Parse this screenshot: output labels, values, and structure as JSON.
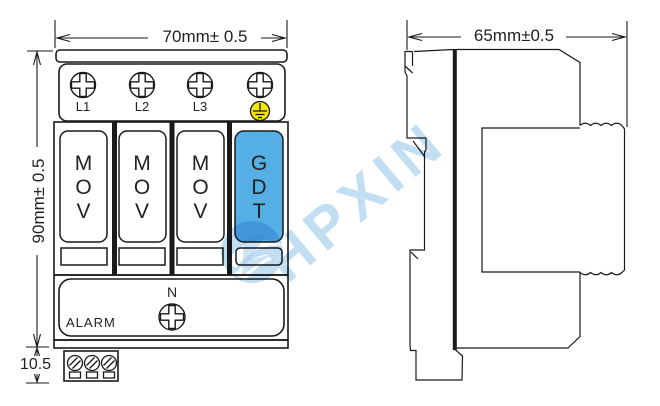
{
  "diagram": {
    "front_view": {
      "width_dim": "70mm± 0.5",
      "height_dim": "90mm± 0.5",
      "base_dim": "10.5",
      "terminal_labels": [
        "L1",
        "L2",
        "L3"
      ],
      "neutral_label": "N",
      "alarm_label": "ALARM",
      "module_labels": [
        "MOV",
        "MOV",
        "MOV",
        "GDT"
      ]
    },
    "side_view": {
      "width_dim": "65mm±0.5"
    },
    "watermark": {
      "text": "HPXIN"
    },
    "colors": {
      "gdt_fill": "#55AEE4",
      "earth_yellow": "#F4E60A",
      "line": "#1a1a1a",
      "watermark_blue": "#9CCAEC"
    }
  }
}
